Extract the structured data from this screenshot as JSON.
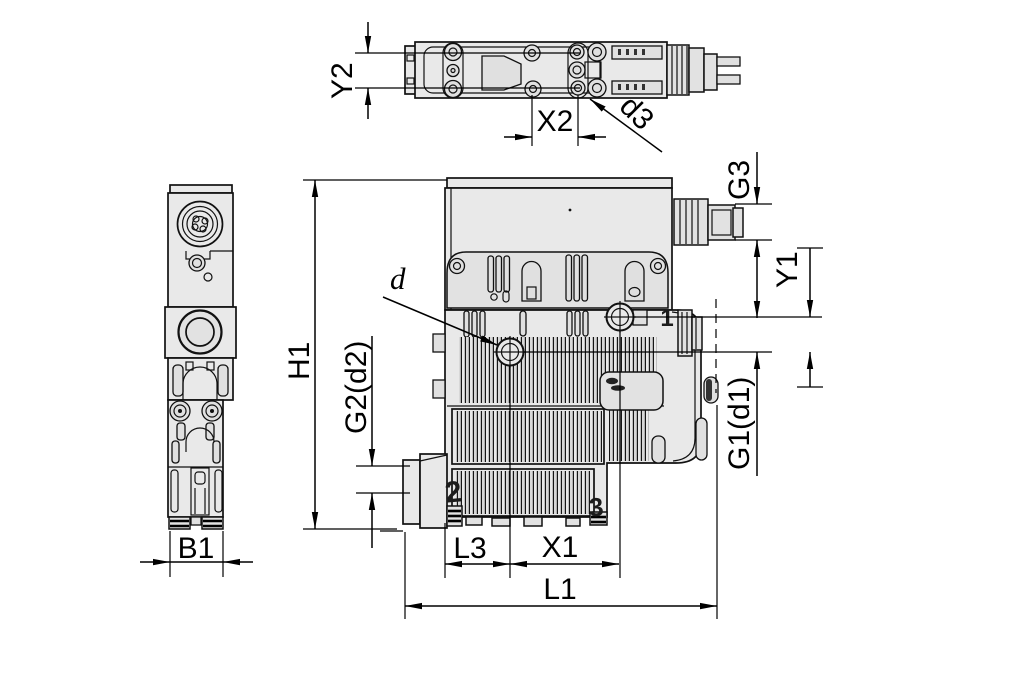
{
  "title": "Compact ejector dimensional drawing",
  "colors": {
    "background": "#ffffff",
    "line": "#111111",
    "body_fill": "#e9e9e9"
  },
  "views": {
    "top": "top view",
    "side": "side view",
    "front": "front view"
  },
  "dims": {
    "y2": "Y2",
    "x2": "X2",
    "d3": "d3",
    "g3": "G3",
    "y1": "Y1",
    "g1d1": "G1(d1)",
    "h1": "H1",
    "d": "d",
    "g2d2": "G2(d2)",
    "b1": "B1",
    "l3": "L3",
    "x1": "X1",
    "l1": "L1"
  },
  "ports": {
    "p1": "1",
    "p2": "2",
    "p3": "3"
  }
}
